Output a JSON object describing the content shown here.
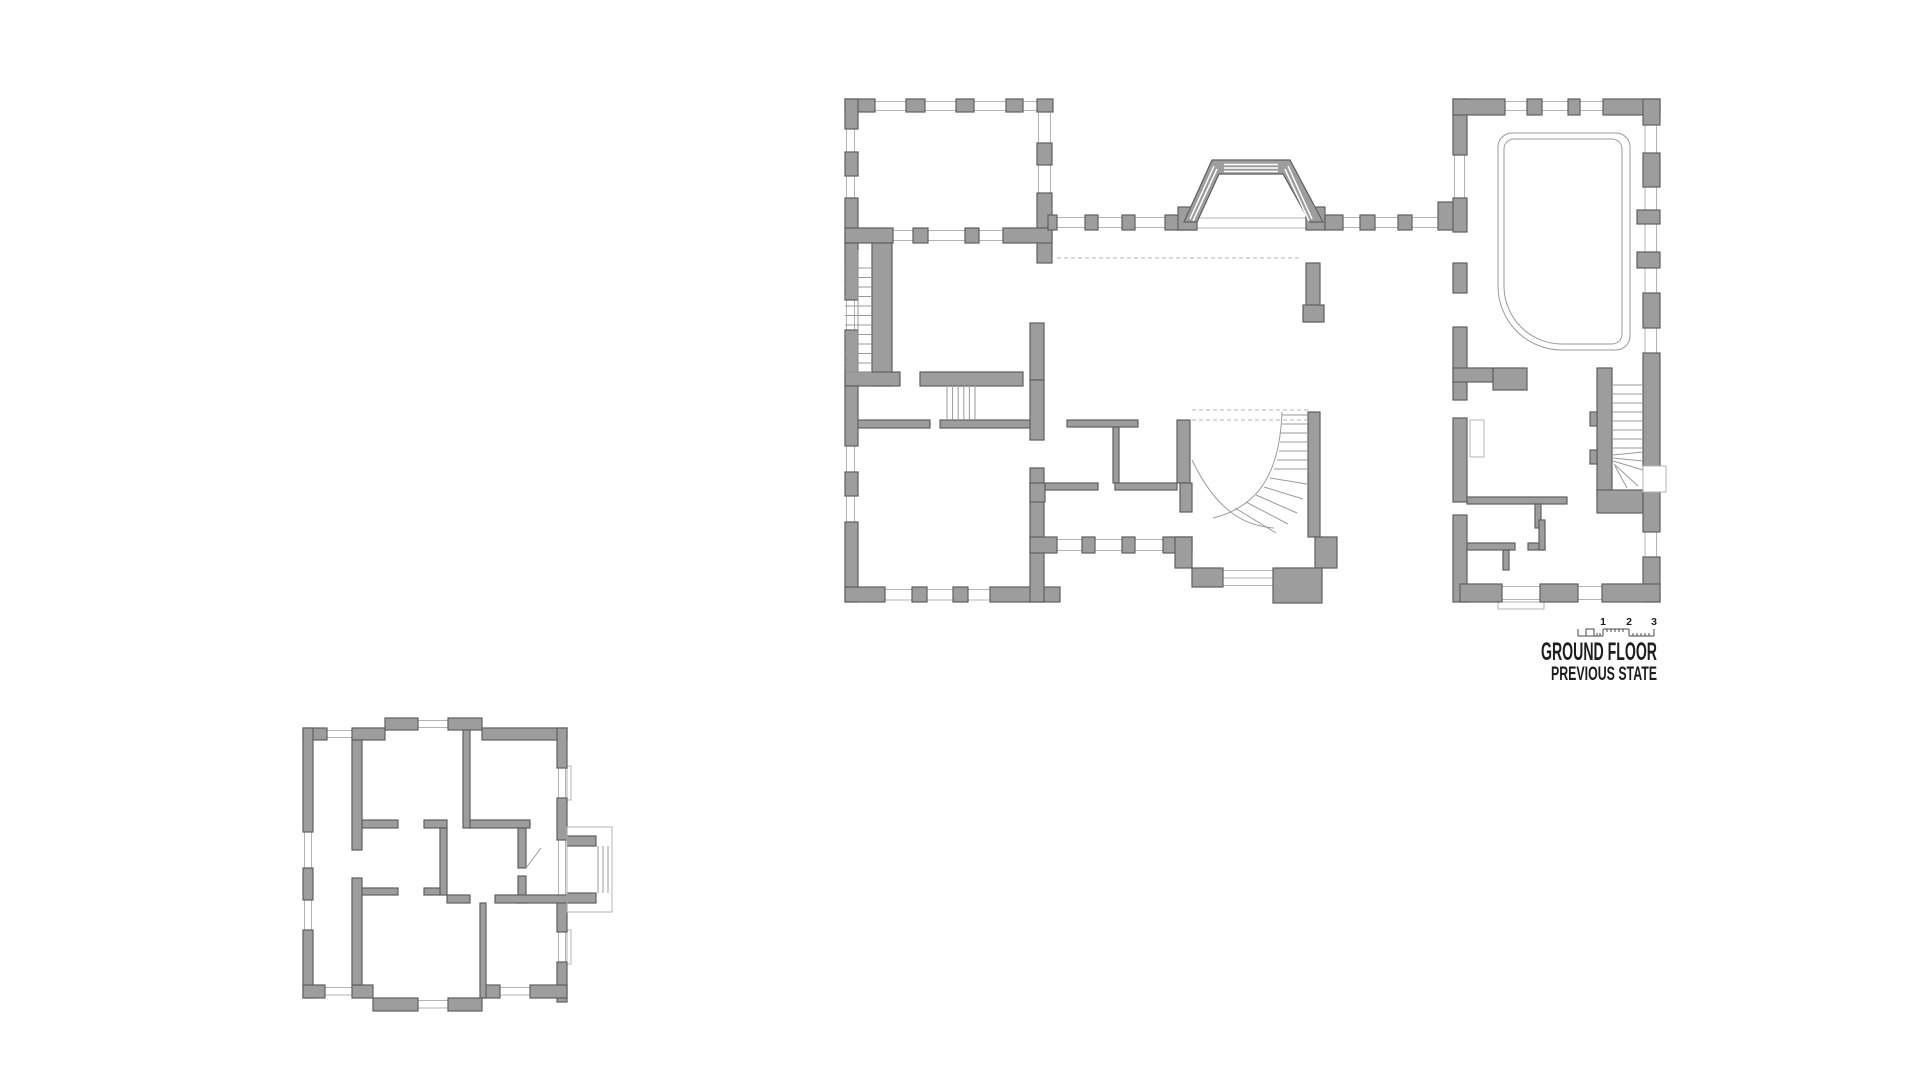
{
  "title": {
    "main": "GROUND FLOOR",
    "subtitle": "PREVIOUS STATE"
  },
  "scale_bar": {
    "labels": [
      "1",
      "2",
      "3"
    ]
  },
  "colors": {
    "background": "#ffffff",
    "wall_fill": "#9d9d9d",
    "wall_outline": "#5f5f5f",
    "window_line": "#b4b4b4",
    "detail_line": "#9a9a9a",
    "text": "#1d1d1d"
  }
}
